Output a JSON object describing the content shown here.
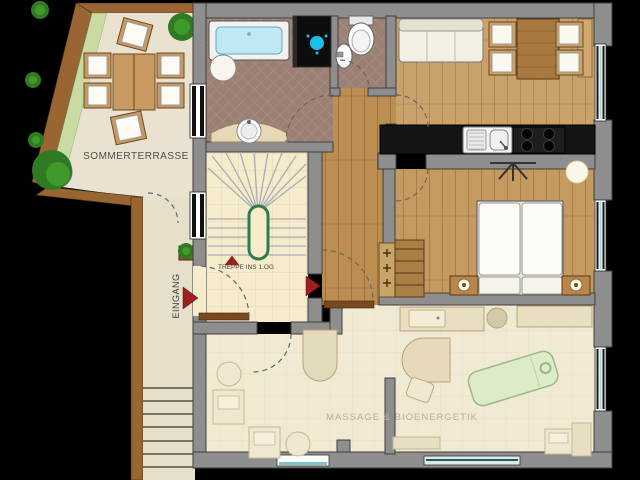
{
  "labels": {
    "terrace": "SOMMERTERRASSE",
    "entrance": "EINGANG",
    "stairs_note": "TREPPE INS 1.OG",
    "massage_room": "MASSAGE & BIOENERGETIK"
  },
  "colors": {
    "wall_gray": "#8e8e8e",
    "wood_border_brown": "#996633",
    "terrace_floor": "#eae2d1",
    "planting_strip_green": "#c9dba2",
    "bath_tile_brown": "#9b8073",
    "cream_tile": "#f6ebca",
    "hall_wood": "#bd8e52",
    "living_wood": "#c9a26b",
    "bedroom_wood": "#c49a60",
    "massage_floor": "#f1ead3",
    "kitchen_counter_black": "#151515",
    "bathtub_water_blue": "#bfe8f2",
    "shower_head_cyan": "#1ac0e8",
    "stair_rail_green": "#2e7d4f",
    "arrow_red": "#9e1f1f",
    "plant_green": "#2f7a23",
    "massage_table_green": "#dcebc8",
    "label_dark": "#4a4a42",
    "label_light": "#b7b09a"
  }
}
